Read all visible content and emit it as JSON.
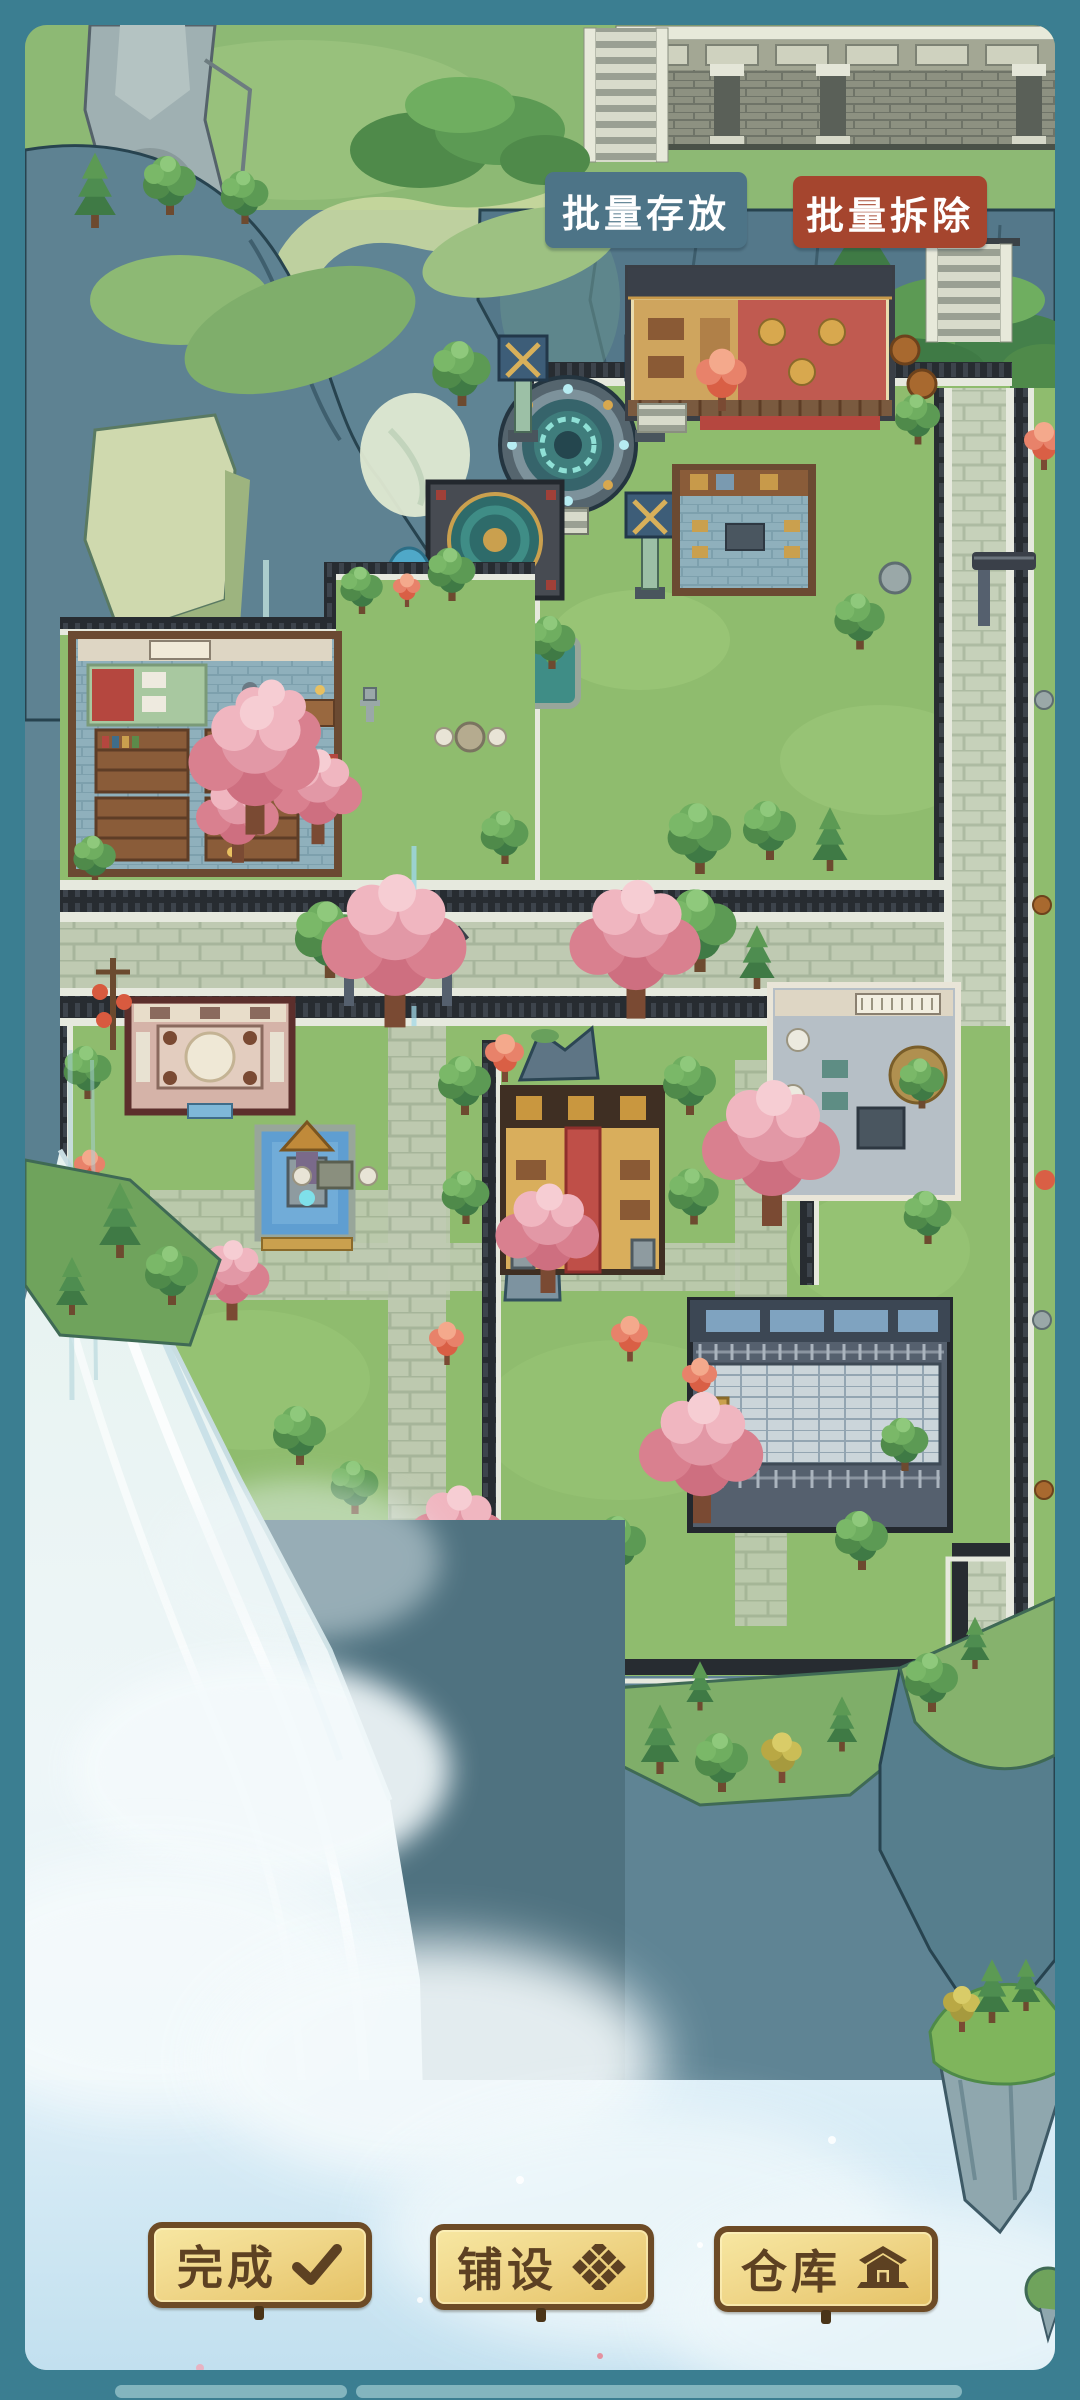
{
  "frame": {
    "border_color": "#3b7e91",
    "nav_hint_color": "#83b5be"
  },
  "top_actions": {
    "store": {
      "label": "批量存放",
      "bg_color": "#4d7487",
      "text_color": "#ffffff"
    },
    "demolish": {
      "label": "批量拆除",
      "bg_color": "#a5452e",
      "text_color": "#ffffff"
    }
  },
  "bottom_actions": {
    "style": {
      "bg_color": "#f0d78a",
      "border_color": "#6d4b26",
      "text_color": "#5d4122"
    },
    "done": {
      "label": "完成",
      "icon": "checkmark-icon"
    },
    "pave": {
      "label": "铺设",
      "icon": "tile-grid-icon"
    },
    "warehouse": {
      "label": "仓库",
      "icon": "warehouse-icon"
    }
  },
  "scene": {
    "type": "sect-garden-map",
    "palette": {
      "grass": "#8fbc6e",
      "cliff": "#54788a",
      "road": "#bfcab2",
      "wall": "#272c31",
      "waterfall": "#eef6f8",
      "pink_tree": "#e298a6"
    }
  }
}
